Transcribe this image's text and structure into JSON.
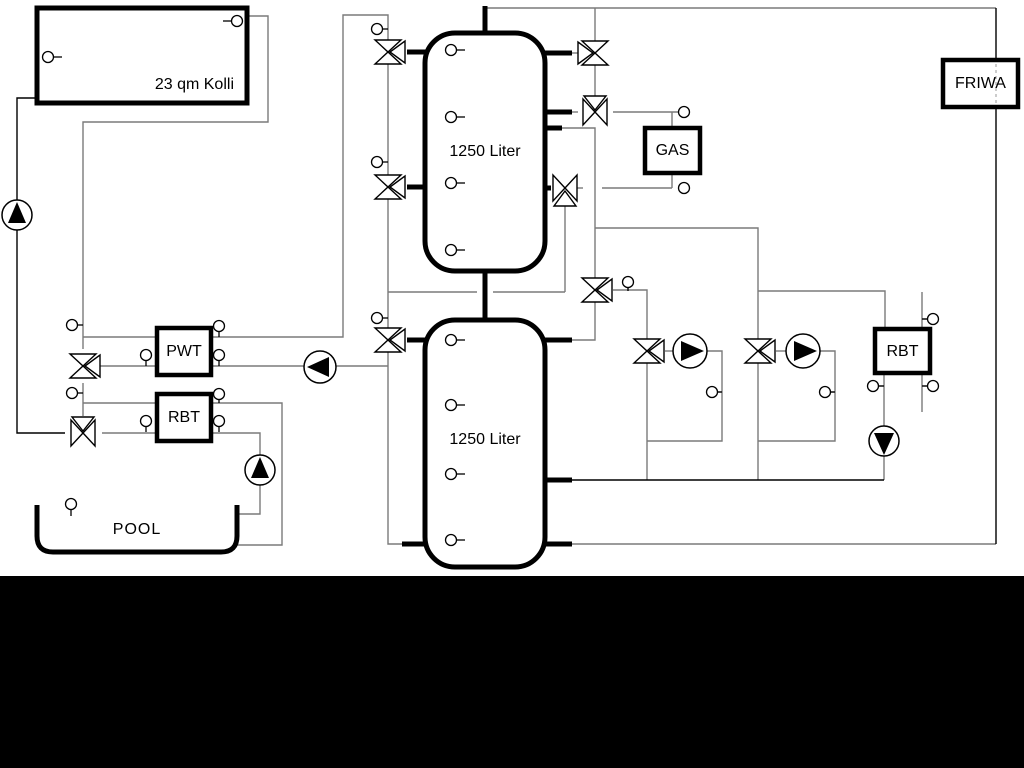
{
  "diagram": {
    "title_hint": "heating / solar / pool piping schematic",
    "collector": {
      "label": "23 qm Kolli"
    },
    "buffer_tank_top": {
      "label": "1250 Liter"
    },
    "buffer_tank_bottom": {
      "label": "1250 Liter"
    },
    "heat_exchanger_pwt": {
      "label": "PWT"
    },
    "heat_exchanger_rbt_pool": {
      "label": "RBT"
    },
    "boiler_gas": {
      "label": "GAS"
    },
    "fresh_water_station": {
      "label": "FRIWA"
    },
    "heat_exchanger_rbt_right": {
      "label": "RBT"
    },
    "pool": {
      "label": "POOL"
    },
    "colors": {
      "background": "#ffffff",
      "bottom_band": "#000000",
      "pipe_gray": "#7a7a7a",
      "pipe_black": "#000000",
      "symbol_outline": "#000000",
      "symbol_fill": "#ffffff"
    }
  }
}
